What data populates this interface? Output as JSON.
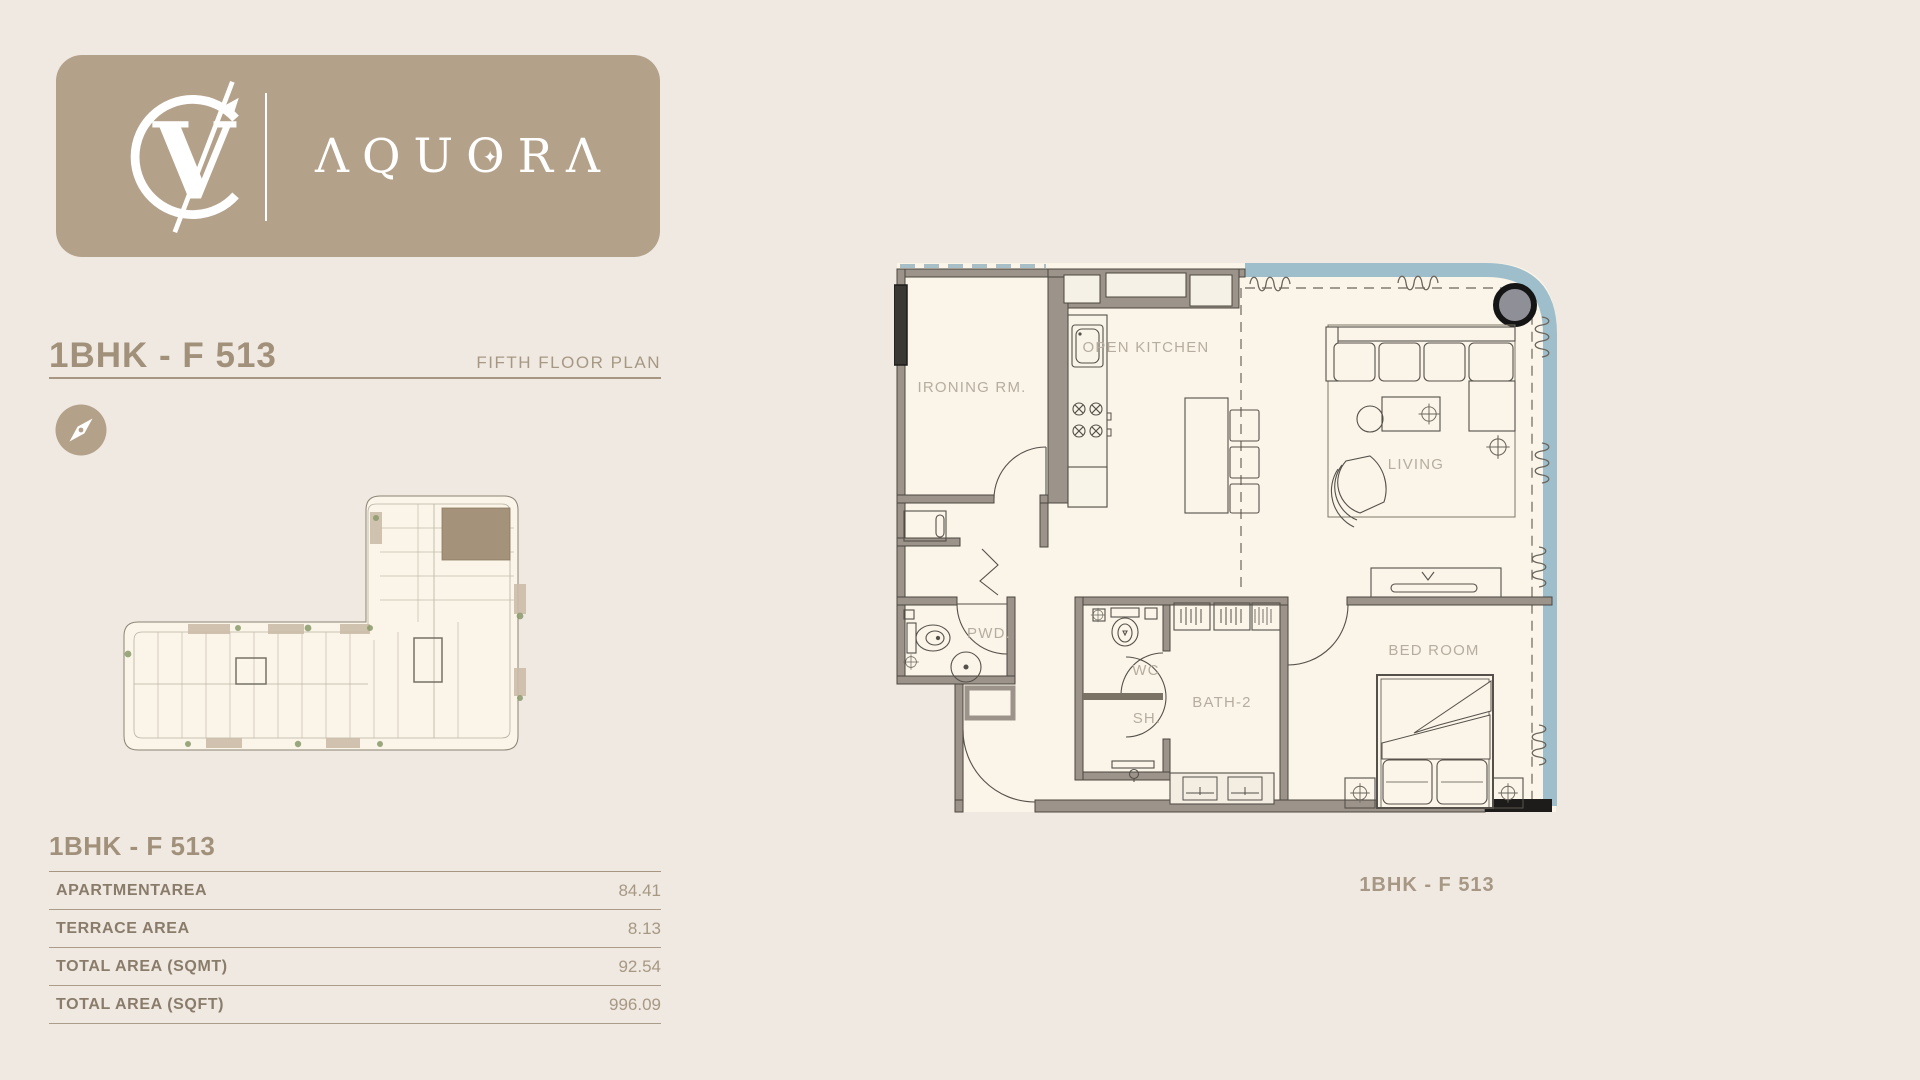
{
  "page": {
    "background": "#f0e9e1"
  },
  "logo": {
    "monogram": "VC",
    "brand": "AQUORA",
    "card_color": "#b3a18a"
  },
  "header": {
    "title": "1BHK - F 513",
    "subtitle": "FIFTH FLOOR PLAN"
  },
  "area_table": {
    "title": "1BHK - F 513",
    "rows": [
      {
        "label": "APARTMENTAREA",
        "value": "84.41"
      },
      {
        "label": "TERRACE AREA",
        "value": "8.13"
      },
      {
        "label": "TOTAL AREA (SQMT)",
        "value": "92.54"
      },
      {
        "label": "TOTAL AREA (SQFT)",
        "value": "996.09"
      }
    ]
  },
  "floor_plan": {
    "caption": "1BHK - F 513",
    "rooms": {
      "ironing": "IRONING RM.",
      "kitchen": "OPEN KITCHEN",
      "living": "LIVING",
      "powder": "PWD.",
      "wc": "WC",
      "shower": "SH.",
      "bath": "BATH-2",
      "bedroom": "BED ROOM"
    }
  },
  "colors": {
    "accent_tan": "#b3a18a",
    "title_tan": "#a1907a",
    "wall_gray": "#9c948b",
    "floor_cream": "#faf5e8",
    "terrace_blue": "#9fbecb",
    "highlight_unit": "#a5927a"
  }
}
